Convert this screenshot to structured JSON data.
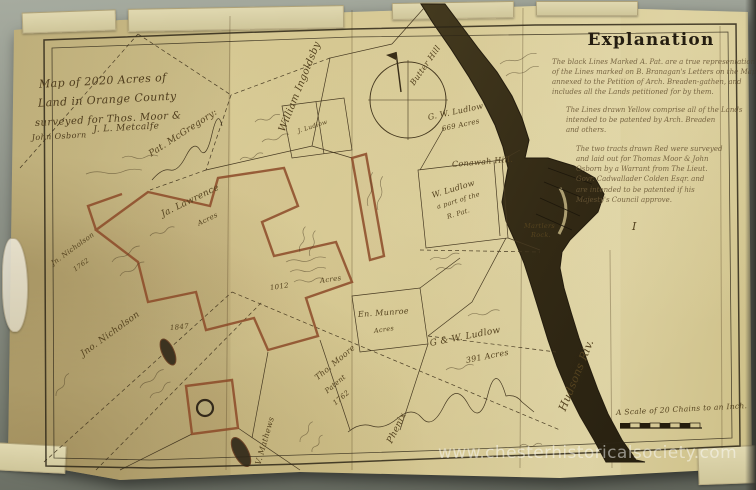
{
  "watermark": "www.chesterhistoricalsociety.com",
  "title_block": {
    "lines": [
      "Map of 2020 Acres of",
      "Land in Orange County",
      "surveyed for Thos. Moor &",
      "John Osborn",
      "J. L. Metcalfe"
    ]
  },
  "explanation": {
    "heading": "Explanation",
    "paragraphs": [
      [
        "The black Lines Marked A. Pat. are a true representation",
        "of the Lines marked on B. Branagan's Letters on the Map",
        "annexed to the Petition of Arch. Breaden-gathen, and",
        "includes all the Lands petitioned for by them."
      ],
      [
        "The Lines drawn Yellow comprise all of the Lands",
        "intended to be patented by Arch. Breaden",
        "and others."
      ],
      [
        "The two tracts drawn Red were surveyed",
        "and laid out for Thomas Moor & John",
        "Osborn by a Warrant from The Lieut.",
        "Govr. Cadwallader Colden Esqr. and",
        "are intended to be patented if his",
        "Majesty's Council approve."
      ]
    ],
    "plate_numeral": "I"
  },
  "scale_caption": "A Scale of 20 Chains to an Inch.",
  "labels": [
    {
      "text": "Pat. McGregory:",
      "x": 150,
      "y": 150,
      "rot": -33,
      "size": 9
    },
    {
      "text": "Ja. Lawrence",
      "x": 162,
      "y": 210,
      "rot": -26,
      "size": 9
    },
    {
      "text": "Acres",
      "x": 198,
      "y": 220,
      "rot": -26,
      "size": 7
    },
    {
      "text": "William Ingoldsby",
      "x": 282,
      "y": 126,
      "rot": -68,
      "size": 10
    },
    {
      "text": "Butter Hill",
      "x": 412,
      "y": 80,
      "rot": -55,
      "size": 8
    },
    {
      "text": "G. W. Ludlow",
      "x": 428,
      "y": 113,
      "rot": -12,
      "size": 8
    },
    {
      "text": "669 Acres",
      "x": 442,
      "y": 125,
      "rot": -12,
      "size": 7
    },
    {
      "text": "Conawah Hill.",
      "x": 452,
      "y": 160,
      "rot": -5,
      "size": 8
    },
    {
      "text": "W. Ludlow",
      "x": 432,
      "y": 191,
      "rot": -17,
      "size": 8
    },
    {
      "text": "a part of the",
      "x": 437,
      "y": 203,
      "rot": -17,
      "size": 6.5
    },
    {
      "text": "R. Pat.",
      "x": 447,
      "y": 213,
      "rot": -17,
      "size": 6.5
    },
    {
      "text": "Martlers",
      "x": 524,
      "y": 222,
      "rot": 0,
      "size": 6.5
    },
    {
      "text": "Rock.",
      "x": 531,
      "y": 231,
      "rot": 0,
      "size": 6.5
    },
    {
      "text": "Hudsons Riv.",
      "x": 562,
      "y": 404,
      "rot": -68,
      "size": 11
    },
    {
      "text": "En. Munroe",
      "x": 358,
      "y": 310,
      "rot": -4,
      "size": 8
    },
    {
      "text": "Acres",
      "x": 374,
      "y": 327,
      "rot": -8,
      "size": 6.5
    },
    {
      "text": "G & W. Ludlow",
      "x": 430,
      "y": 339,
      "rot": -11,
      "size": 9
    },
    {
      "text": "391 Acres",
      "x": 466,
      "y": 356,
      "rot": -11,
      "size": 8
    },
    {
      "text": "Tho. Moore",
      "x": 316,
      "y": 374,
      "rot": -40,
      "size": 8
    },
    {
      "text": "Patent",
      "x": 326,
      "y": 388,
      "rot": -40,
      "size": 7
    },
    {
      "text": "1762",
      "x": 334,
      "y": 400,
      "rot": -40,
      "size": 7
    },
    {
      "text": "Jno. Nicholson",
      "x": 82,
      "y": 350,
      "rot": -36,
      "size": 9
    },
    {
      "text": "Jn. Nicholson",
      "x": 52,
      "y": 260,
      "rot": -36,
      "size": 7
    },
    {
      "text": "1762",
      "x": 74,
      "y": 266,
      "rot": -36,
      "size": 6.5
    },
    {
      "text": "V. Mathews",
      "x": 258,
      "y": 460,
      "rot": -74,
      "size": 8
    },
    {
      "text": "Phenix",
      "x": 390,
      "y": 438,
      "rot": -64,
      "size": 9
    },
    {
      "text": "J. Ludlow",
      "x": 298,
      "y": 128,
      "rot": -18,
      "size": 6
    },
    {
      "text": "1012",
      "x": 270,
      "y": 284,
      "rot": -8,
      "size": 7
    },
    {
      "text": "Acres",
      "x": 320,
      "y": 277,
      "rot": -8,
      "size": 7
    },
    {
      "text": "1847",
      "x": 170,
      "y": 324,
      "rot": -5,
      "size": 7
    },
    {
      "text": "I",
      "x": 632,
      "y": 220,
      "rot": 0,
      "size": 11
    }
  ],
  "colors": {
    "paper": "#d3c48c",
    "river": "#362d18",
    "red_tract": "#8c4a28",
    "ink": "#473a22",
    "background": "#8b9086"
  }
}
